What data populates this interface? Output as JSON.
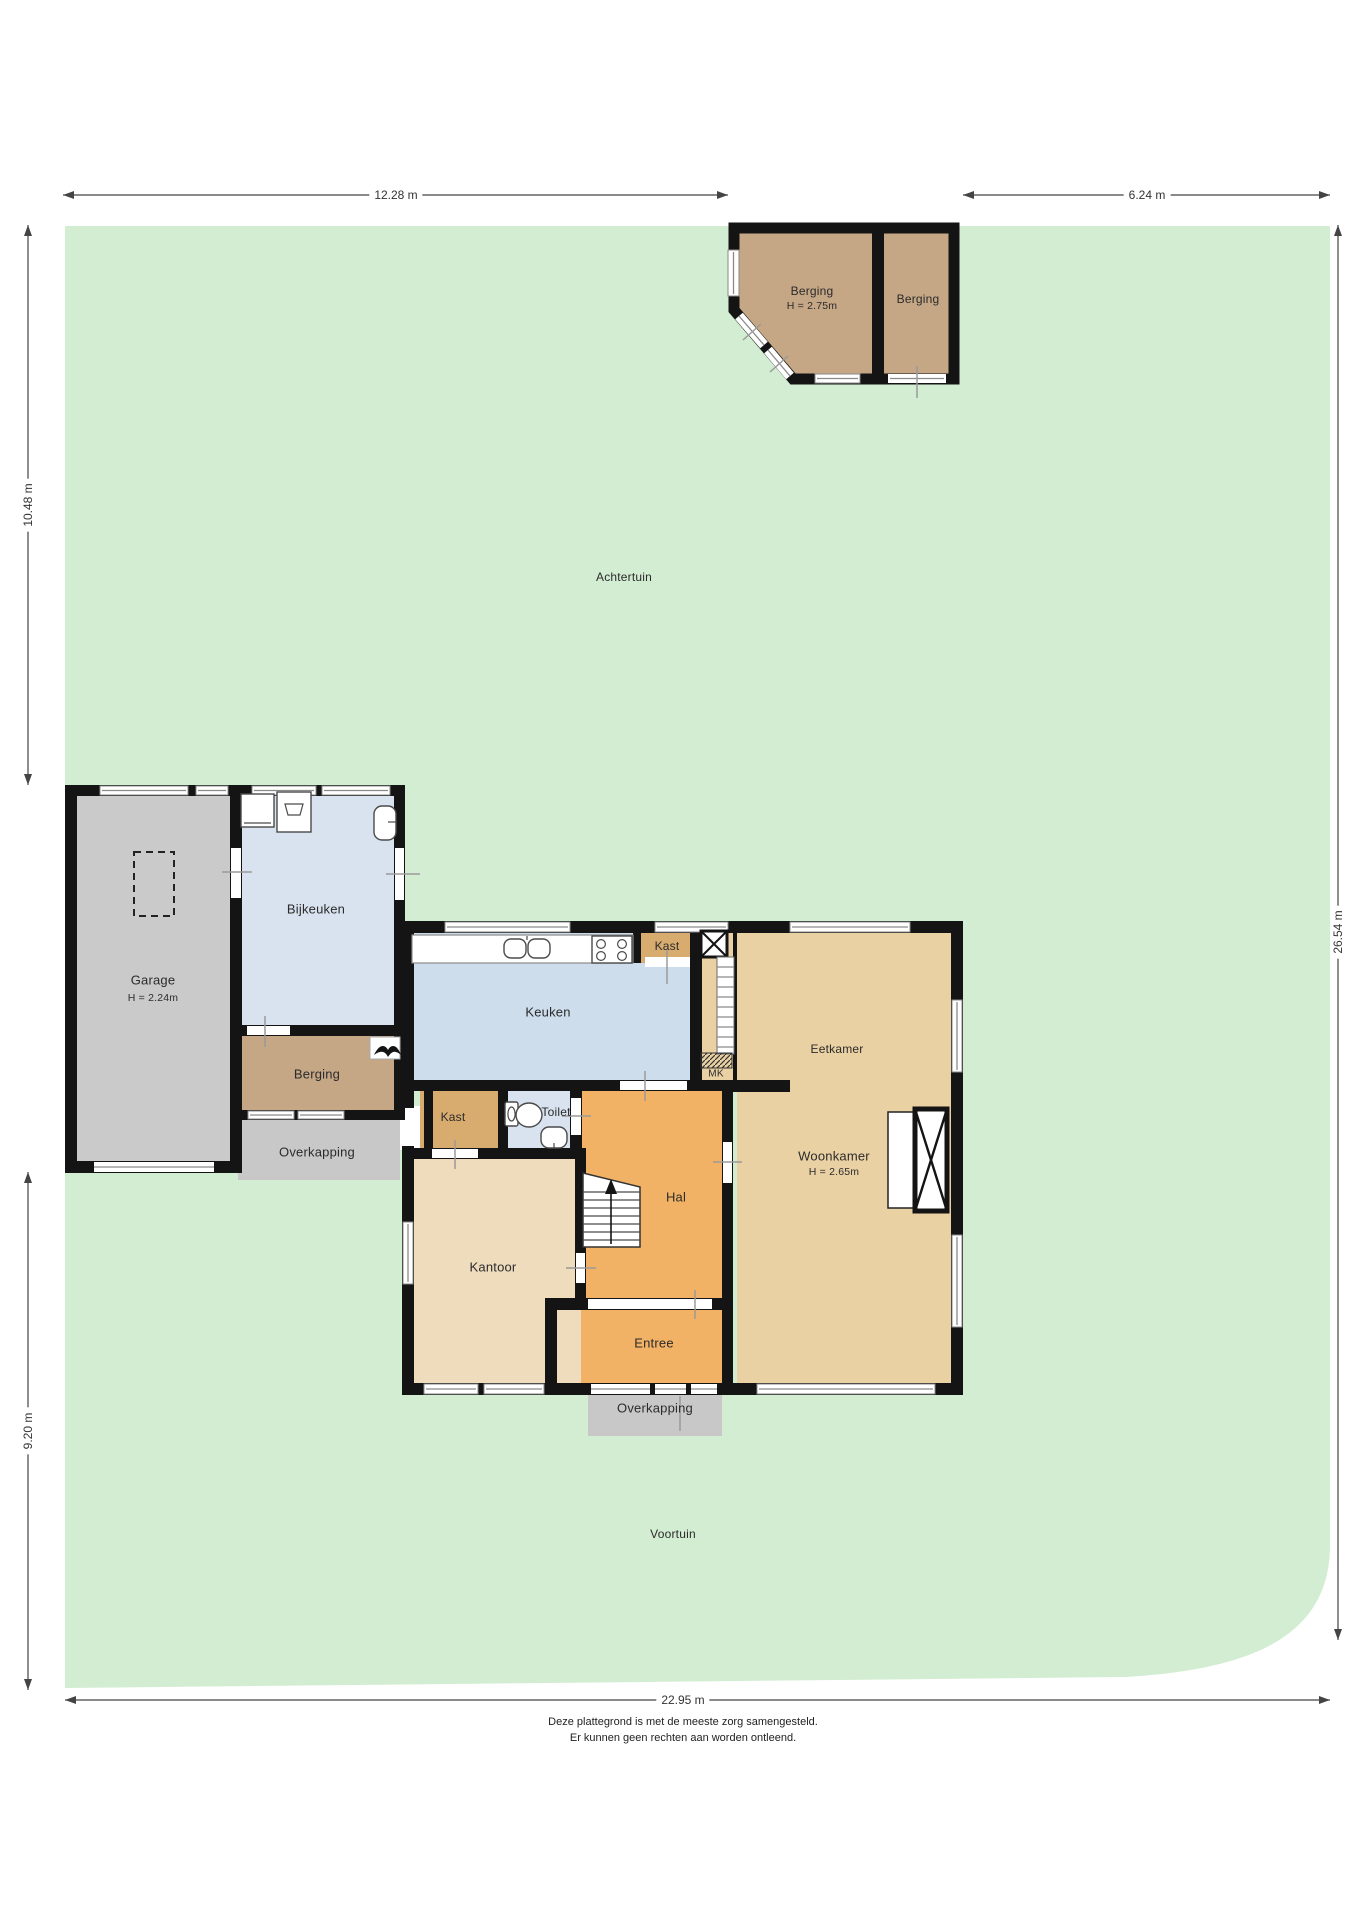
{
  "dimensions": {
    "top_left": "12.28 m",
    "top_right": "6.24 m",
    "left_upper": "10.48 m",
    "left_lower": "9.20 m",
    "right": "26.54 m",
    "bottom": "22.95 m"
  },
  "rooms": {
    "berging_shed_left": {
      "label": "Berging",
      "height": "H = 2.75m"
    },
    "berging_shed_right": {
      "label": "Berging"
    },
    "achtertuin": {
      "label": "Achtertuin"
    },
    "garage": {
      "label": "Garage",
      "height": "H = 2.24m"
    },
    "bijkeuken": {
      "label": "Bijkeuken"
    },
    "keuken": {
      "label": "Keuken"
    },
    "kast_keuken": {
      "label": "Kast"
    },
    "eetkamer": {
      "label": "Eetkamer"
    },
    "berging_house": {
      "label": "Berging"
    },
    "overkapping_side": {
      "label": "Overkapping"
    },
    "kast_hal": {
      "label": "Kast"
    },
    "toilet": {
      "label": "Toilet"
    },
    "woonkamer": {
      "label": "Woonkamer",
      "height": "H = 2.65m"
    },
    "hal": {
      "label": "Hal"
    },
    "kantoor": {
      "label": "Kantoor"
    },
    "entree": {
      "label": "Entree"
    },
    "overkapping_front": {
      "label": "Overkapping"
    },
    "voortuin": {
      "label": "Voortuin"
    },
    "meterkast": {
      "label": "MK"
    }
  },
  "footer": {
    "line1": "Deze plattegrond is met de meeste zorg samengesteld.",
    "line2": "Er kunnen geen rechten aan worden ontleend."
  },
  "colors": {
    "garden": "#d3edd3",
    "shed": "#c5a685",
    "garage": "#cacaca",
    "bijkeuken": "#d8e3ef",
    "keuken": "#cdddec",
    "kast": "#d8ab6e",
    "eetkamer": "#ead1a3",
    "hal": "#f2b265",
    "kantoor": "#eedcbd",
    "toilet": "#d8e3ef",
    "berging_house": "#c5a685",
    "overkapping": "#c8c8c8",
    "wall": "#141414"
  }
}
